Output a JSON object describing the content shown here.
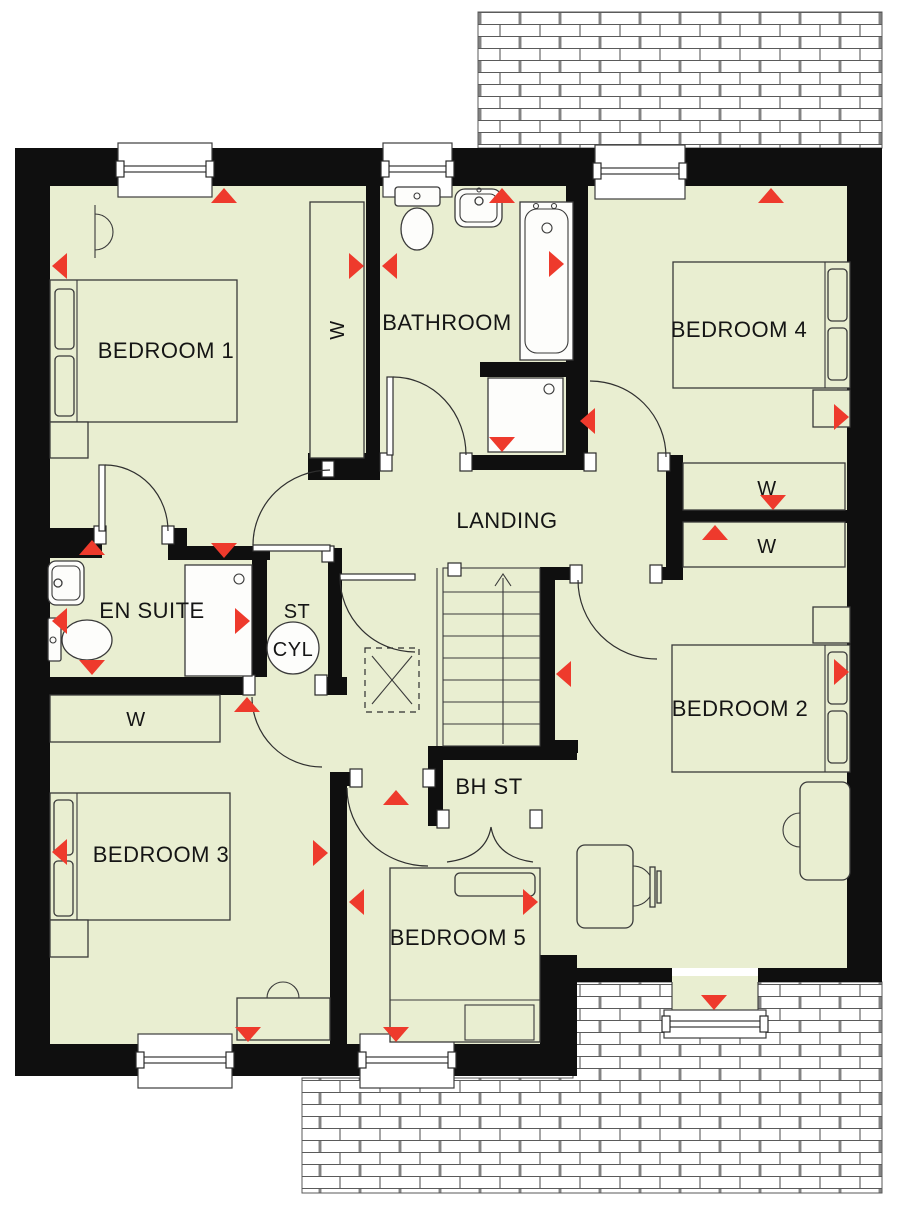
{
  "colors": {
    "floor": "#e9eed1",
    "wall": "#0f0f0f",
    "accent": "#ee3a2c",
    "line": "#3a3a3a"
  },
  "labels": {
    "bedroom1": "BEDROOM 1",
    "bathroom": "BATHROOM",
    "bedroom4": "BEDROOM 4",
    "landing": "LANDING",
    "en_suite": "EN SUITE",
    "st": "ST",
    "cyl": "CYL",
    "bedroom2": "BEDROOM 2",
    "bedroom3": "BEDROOM 3",
    "bedroom5": "BEDROOM 5",
    "bh_st": "BH ST",
    "wardrobe": "W"
  }
}
